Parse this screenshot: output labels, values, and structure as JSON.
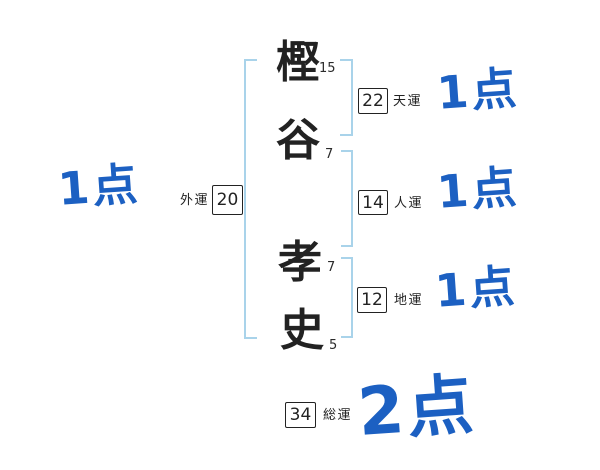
{
  "name": {
    "characters": [
      {
        "char": "樫",
        "strokes": "15"
      },
      {
        "char": "谷",
        "strokes": "7"
      },
      {
        "char": "孝",
        "strokes": "7"
      },
      {
        "char": "史",
        "strokes": "5"
      }
    ]
  },
  "fortunes": {
    "outer": {
      "label": "外運",
      "value": "20",
      "score": "1点"
    },
    "heaven": {
      "label": "天運",
      "value": "22",
      "score": "1点"
    },
    "person": {
      "label": "人運",
      "value": "14",
      "score": "1点"
    },
    "earth": {
      "label": "地運",
      "value": "12",
      "score": "1点"
    },
    "total": {
      "label": "総運",
      "value": "34",
      "score": "2点"
    }
  },
  "colors": {
    "score_blue": "#1c60c2",
    "bracket_blue": "#a9d3ea",
    "ink": "#222222"
  }
}
